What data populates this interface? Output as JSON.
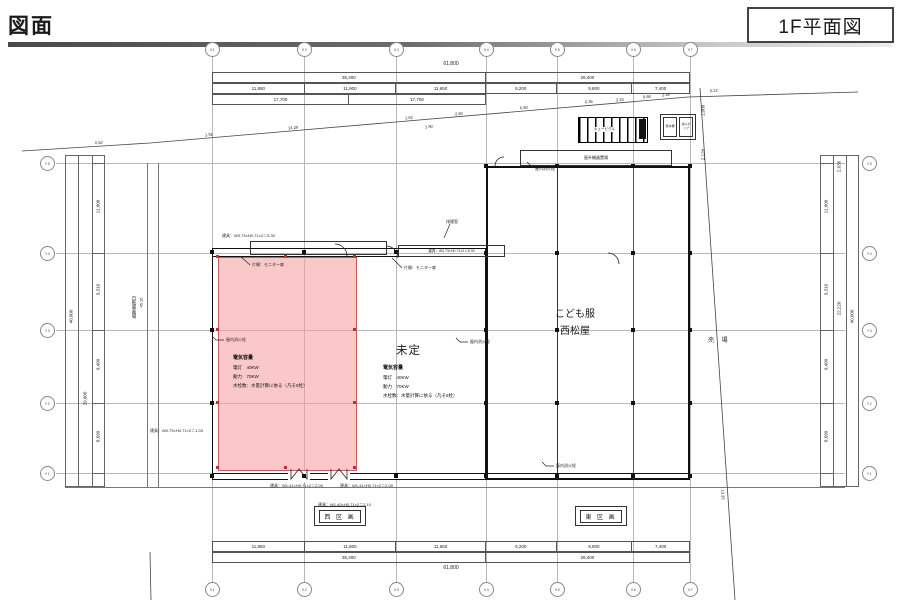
{
  "header": {
    "doc_title": "図面",
    "sheet_title": "1F平面図"
  },
  "axes": {
    "x": [
      "X1",
      "X2",
      "X3",
      "X4",
      "X5",
      "X6",
      "X7"
    ],
    "y": [
      "Y5",
      "Y4",
      "Y3",
      "Y2",
      "Y1"
    ]
  },
  "dims": {
    "total": "61,800",
    "top": {
      "groups": [
        "35,400",
        "26,400"
      ],
      "spans": [
        "11,850",
        "11,900",
        "11,650",
        "9,200",
        "9,800",
        "7,400"
      ],
      "sub": [
        "17,700",
        "17,700"
      ]
    },
    "bottom": {
      "groups": [
        "35,400",
        "26,400"
      ],
      "spans": [
        "11,850",
        "11,800",
        "11,650",
        "9,200",
        "9,800",
        "7,400"
      ]
    },
    "left": {
      "total": "40,000",
      "group": "20,000",
      "spans": [
        "11,000",
        "9,310",
        "9,400",
        "8,690"
      ]
    },
    "right": {
      "total": "40,000",
      "group": "22,220",
      "top_offset": "2,636",
      "spans": [
        "11,000",
        "9,310",
        "9,400",
        "8,690"
      ]
    },
    "misc": {
      "v1": "1,000",
      "v2": "2,120"
    }
  },
  "rooms": {
    "undecided": "未定",
    "kids_line1": "こども服",
    "kids_line2": "西松屋",
    "sales": "売 場"
  },
  "specs": {
    "title": "電気容量",
    "light": "電灯　40KW",
    "power": "動力　70KW",
    "water": "水栓数：水量計算に依る（凡そ5栓）"
  },
  "sections": {
    "west": "西 区 画",
    "east": "東 区 画"
  },
  "equipment": {
    "outdoor": "屋外機器置場",
    "cubicle": "キュービクル",
    "tank": "受水槽",
    "pump": "消火ポンプ"
  },
  "annotations": {
    "hydrant": "屋内消火栓",
    "door_a": "建具：W3.73×H0.71×2＝5.30",
    "monitor": "片開：モニター扉",
    "smoke": "排煙窓",
    "door_c": "建具：W1.41×H0.71×2＝2.00",
    "door_d": "建具：W1.40×H0.71×2＝2.10",
    "door_e": "建具：W0.73×H0.71×2＝1.03",
    "bike": "自転車置場",
    "bike_num": "45.16"
  },
  "boundary": {
    "top": [
      "0.52",
      "1.91",
      "14.29",
      "1.62",
      "1.90",
      "2.50",
      "6.50",
      "6.45",
      "2.24",
      "5.68",
      "2.28",
      "0.22"
    ],
    "right": "13.33"
  },
  "colors": {
    "highlight": "#f5a3a3",
    "highlight_border": "#c06060",
    "wall": "#111111",
    "grid": "#b5b5b5"
  }
}
